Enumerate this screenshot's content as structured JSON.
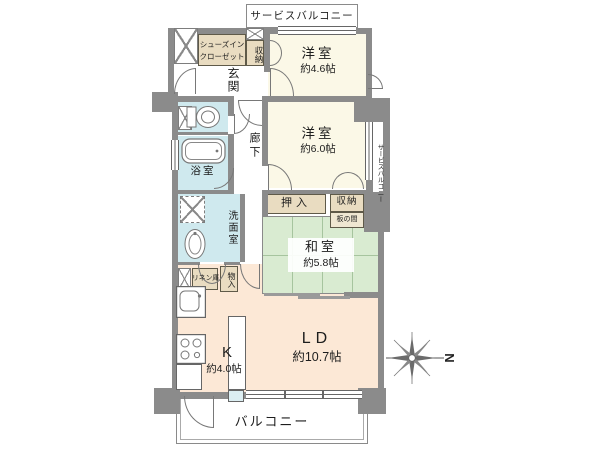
{
  "colors": {
    "wall": "#8b8b8b",
    "western_room": "#fbf8e7",
    "japanese_room": "#d9ebd1",
    "ldk": "#fce8d6",
    "wet_area": "#cfe9ee",
    "storage": "#e9dcc1",
    "tatami_line": "#a6c49e"
  },
  "plan": {
    "balcony_top": {
      "label": "サービスバルコニー"
    },
    "shoes_closet": {
      "line1": "シューズイン",
      "line2": "クローゼット"
    },
    "storage_top": {
      "label": "収納"
    },
    "entrance": {
      "label": "玄関"
    },
    "western_room_1": {
      "name": "洋室",
      "size": "約4.6帖"
    },
    "western_room_2": {
      "name": "洋室",
      "size": "約6.0帖"
    },
    "service_balcony_right": {
      "label": "サービスバルコニー"
    },
    "hallway": {
      "label": "廊下"
    },
    "bathroom": {
      "label": "浴室"
    },
    "washroom": {
      "label": "洗面室"
    },
    "closet_oshiire": {
      "label": "押入"
    },
    "storage_mid": {
      "label": "収納"
    },
    "itanoma": {
      "label": "板の間"
    },
    "japanese_room": {
      "name": "和室",
      "size": "約5.8帖"
    },
    "linen": {
      "label": "リネン庫"
    },
    "storage_small": {
      "label": "物入"
    },
    "kitchen": {
      "name": "K",
      "size": "約4.0帖"
    },
    "living_dining": {
      "name": "LD",
      "size": "約10.7帖"
    },
    "balcony_bottom": {
      "label": "バルコニー"
    },
    "compass": {
      "label": "N"
    }
  }
}
